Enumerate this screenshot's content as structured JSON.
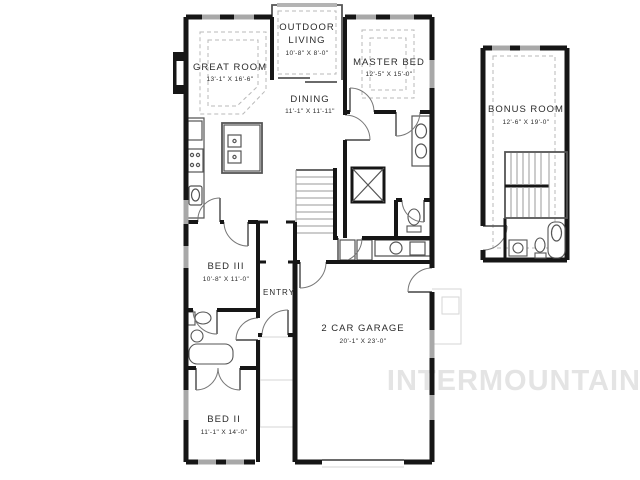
{
  "watermark": "INTERMOUNTAIN",
  "colors": {
    "wall": "#161616",
    "thin": "#555555",
    "dash": "#b8b8b8",
    "window": "#a8a8a8",
    "watermark": "#e4e4e4",
    "text": "#2b2b2b"
  },
  "rooms": {
    "great_room": {
      "name": "GREAT ROOM",
      "dims": "13'-1\" X 16'-6\""
    },
    "outdoor_living": {
      "name_line1": "OUTDOOR",
      "name_line2": "LIVING",
      "dims": "10'-8\" X 8'-0\""
    },
    "master_bed": {
      "name": "MASTER BED",
      "dims": "12'-5\" X 15'-0\""
    },
    "dining": {
      "name": "DINING",
      "dims": "11'-1\" X 11'-11\""
    },
    "bonus_room": {
      "name": "BONUS ROOM",
      "dims": "12'-6\" X 19'-0\""
    },
    "bed_3": {
      "name": "BED III",
      "dims": "10'-8\" X 11'-0\""
    },
    "entry": {
      "name": "ENTRY"
    },
    "garage": {
      "name": "2 CAR GARAGE",
      "dims": "20'-1\" X 23'-0\""
    },
    "bed_2": {
      "name": "BED II",
      "dims": "11'-1\" X 14'-0\""
    }
  }
}
